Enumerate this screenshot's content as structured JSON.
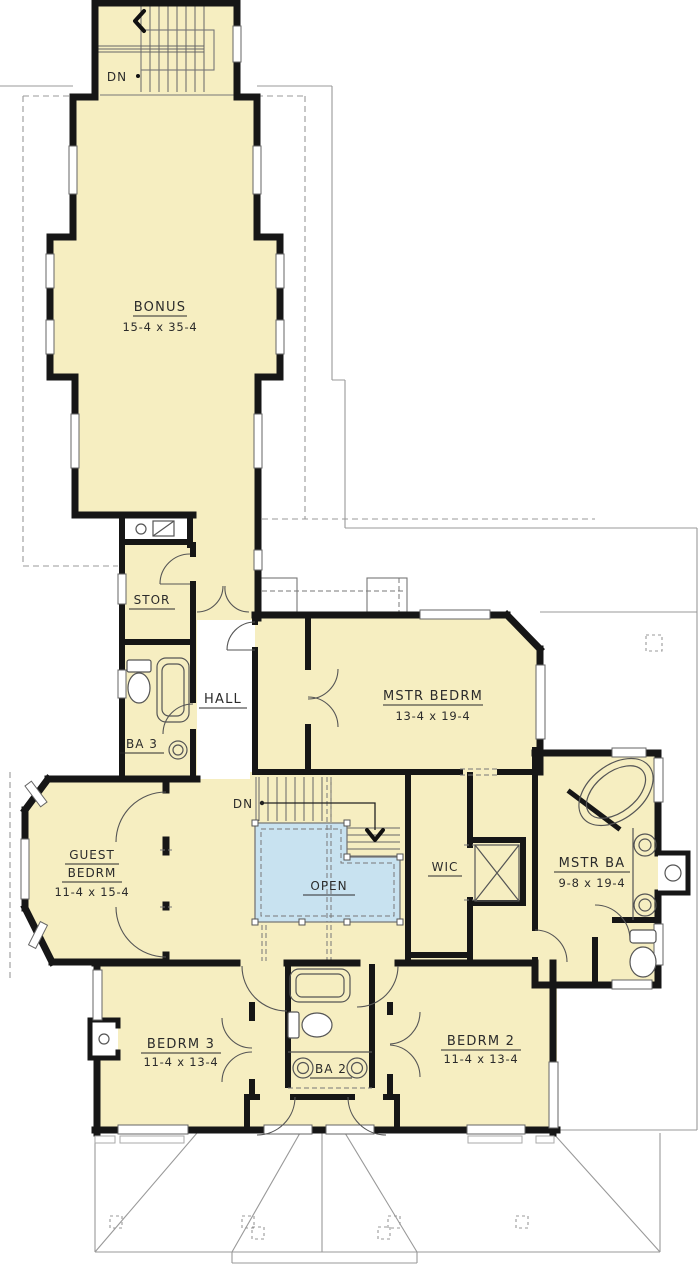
{
  "colors": {
    "room_fill": "#f6eec1",
    "open_fill": "#c8e2f0",
    "wall": "#161616",
    "roof_line": "#999999",
    "window_stroke": "#666666",
    "fixture_line": "#555555",
    "text_color": "#2b2b2b"
  },
  "stairs": {
    "top_label": "DN",
    "main_label": "DN"
  },
  "rooms": {
    "bonus": {
      "name": "BONUS",
      "dims": "15-4 x 35-4"
    },
    "stor": {
      "name": "STOR"
    },
    "hall": {
      "name": "HALL"
    },
    "ba3": {
      "name": "BA 3"
    },
    "mstr_bedrm": {
      "name": "MSTR BEDRM",
      "dims": "13-4 x 19-4"
    },
    "guest_bedrm": {
      "name_line1": "GUEST",
      "name_line2": "BEDRM",
      "dims": "11-4 x 15-4"
    },
    "open_to_below": {
      "name": "OPEN"
    },
    "wic": {
      "name": "WIC"
    },
    "mstr_ba": {
      "name": "MSTR BA",
      "dims": "9-8 x 19-4"
    },
    "bedrm3": {
      "name": "BEDRM 3",
      "dims": "11-4 x 13-4"
    },
    "ba2": {
      "name": "BA 2"
    },
    "bedrm2": {
      "name": "BEDRM 2",
      "dims": "11-4 x 13-4"
    }
  }
}
